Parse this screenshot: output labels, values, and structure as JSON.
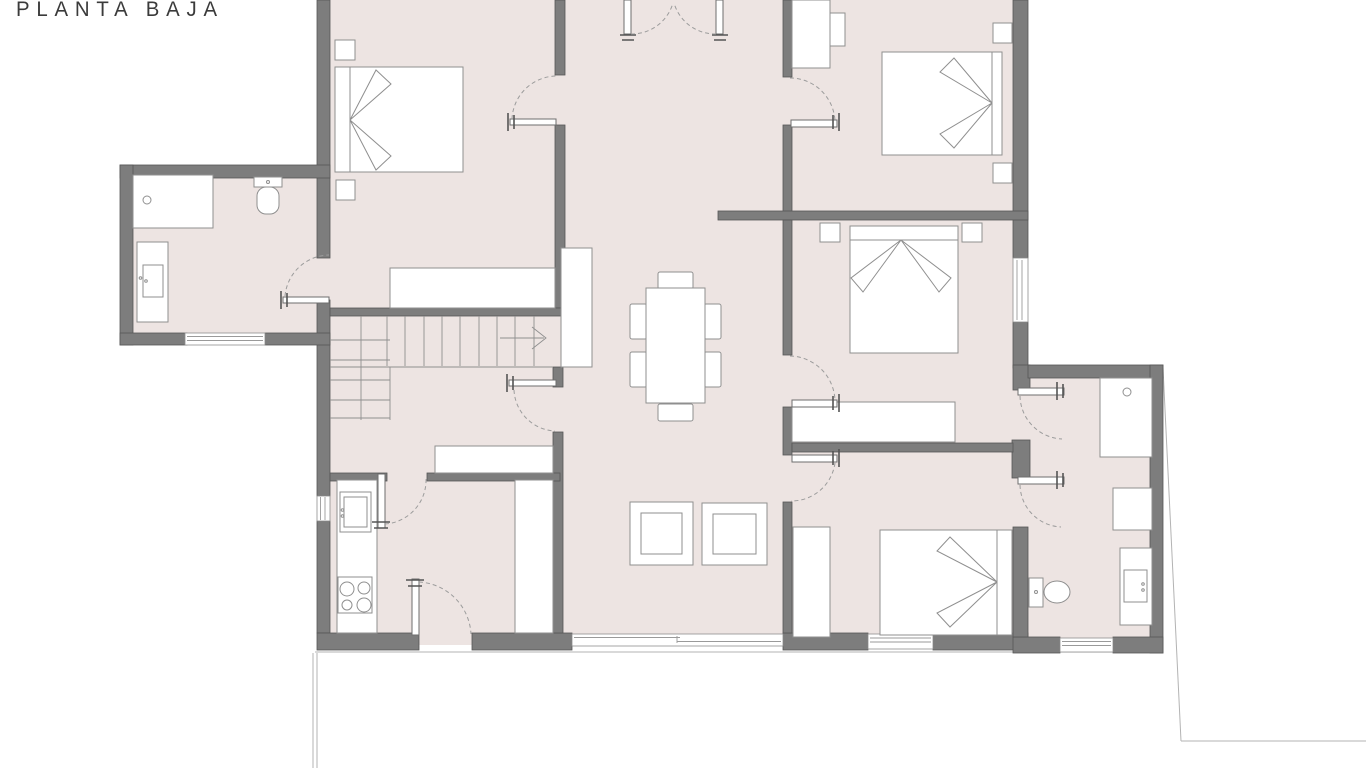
{
  "title": "PLANTA BAJA",
  "colors": {
    "background": "#ffffff",
    "floor": "#ede4e2",
    "wall": "#7d7d7d",
    "wallStroke": "#565656",
    "furniture": "#8f8f8f",
    "arc": "#9c9c9c",
    "terrain": "#b3b3b3",
    "text": "#3b3b3b"
  },
  "plan": {
    "drawing_type": "architectural floor plan",
    "rooms": [
      {
        "name": "bedroom-top-left",
        "fixtures": [
          "double-bed",
          "nightstand",
          "nightstand",
          "wardrobe"
        ]
      },
      {
        "name": "bathroom-annex-left",
        "fixtures": [
          "bathtub",
          "toilet",
          "vanity-sink",
          "window"
        ]
      },
      {
        "name": "entry-hall-top-center",
        "fixtures": [
          "double-swing-door"
        ]
      },
      {
        "name": "bedroom-top-right",
        "fixtures": [
          "double-bed",
          "nightstand",
          "nightstand",
          "wardrobe"
        ]
      },
      {
        "name": "bedroom-middle-right",
        "fixtures": [
          "double-bed",
          "nightstand",
          "nightstand",
          "dresser",
          "window"
        ]
      },
      {
        "name": "bedroom-bottom-right",
        "fixtures": [
          "double-bed",
          "wardrobe",
          "window"
        ]
      },
      {
        "name": "bathroom-right-wing",
        "fixtures": [
          "shower",
          "cabinet",
          "vanity-sink",
          "toilet",
          "window"
        ]
      },
      {
        "name": "staircase-hall",
        "fixtures": [
          "stairs-up-arrow",
          "winder-steps",
          "door"
        ]
      },
      {
        "name": "kitchen",
        "fixtures": [
          "counter",
          "sink",
          "stove-4-burners",
          "fridge-pantry",
          "window",
          "entrance-door"
        ]
      },
      {
        "name": "living-dining-room",
        "fixtures": [
          "dining-table-6-chairs",
          "tv-sideboard",
          "console",
          "two-square-seats",
          "sliding-glass-door"
        ]
      }
    ],
    "site_lines": [
      "terrace-edge-bottom",
      "plot-diagonal-right"
    ]
  }
}
